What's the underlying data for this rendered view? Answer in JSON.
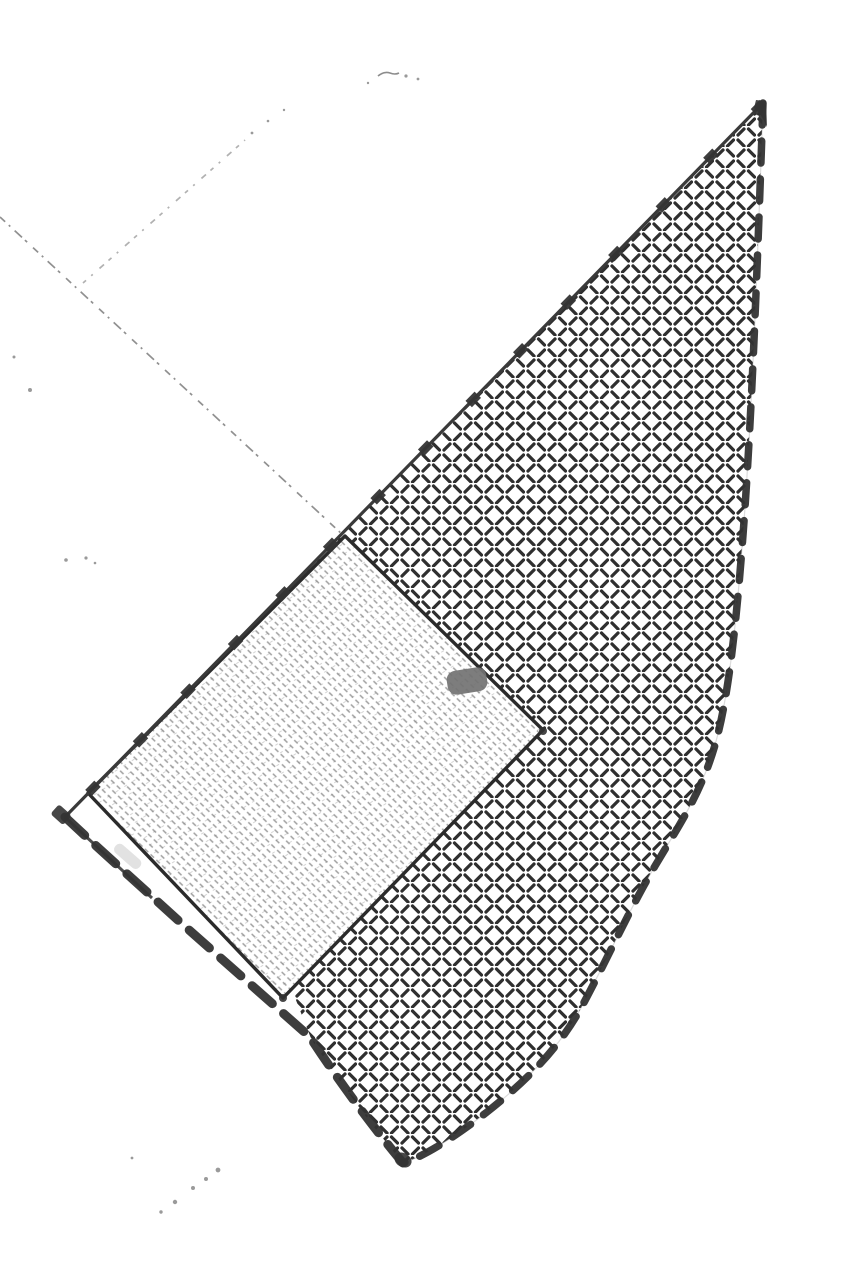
{
  "scene": {
    "type": "scanned hand-drawn cadastral sketch",
    "background": "#ffffff",
    "regions": {
      "hatched_parcel": "large curved triangular area filled with alternating diagonal dash hatching, bounded by heavy dashed ink lines",
      "ruled_parcel": "rotated rectangular area filled with fine broken ruled shading, thin solid ink border",
      "gap_strip": "narrow white strip between rectangle bottom edge and heavy dashed boundary",
      "redaction_blob": "small solid gray rounded blob near rectangle top edge",
      "pencil_lines": "faint broken pencil construction lines extending to upper left"
    }
  },
  "colors": {
    "ink": "#2f2f2f",
    "ink_soft": "#333333",
    "pencil": "#7d7d7d",
    "texture": "#606060",
    "smudge": "#cacaca",
    "blob_gray": "#727272",
    "background": "#ffffff"
  },
  "geometry": {
    "sail_fill": "M763 103 C757 280 751 430 743 535 C736 628 728 700 715 745 C701 793 681 822 655 866 C628 912 607 960 581 1008 C556 1053 521 1085 487 1112 C460 1133 426 1156 403 1163 C381 1137 341 1085 310 1037 L180 922 C145 890 100 850 65 817 Z",
    "sail_right_edge": "M763 103 C757 280 751 430 743 535 C736 628 728 700 715 745 C701 793 681 822 655 866 C628 912 607 960 581 1008 C556 1053 521 1085 487 1112 C460 1133 426 1156 403 1163",
    "sail_left_edge": "M763 103 L65 817",
    "sail_bottom_edge": "M65 817 C100 850 145 890 180 922 L310 1037 C341 1085 381 1137 403 1163",
    "sail_bottom_solid": "M65 817 L152 898",
    "gap_strip": "94,788 292,990 314,1046 58,822",
    "parcel": "345,536 543,730 283,998 88,793",
    "pencil_line_a": "M0 217 L343 535",
    "pencil_line_b": "M83 283 L245 140",
    "squiggle": "M378 76 Q384 71 390 73 Q395 75 399 73",
    "specks_upper": "M14 357 m-1.5 0 a1.5 1.5 0 1 0 3 0 a1.5 1.5 0 1 0 -3 0 Z M30 390 m-2 0 a2 2 0 1 0 4 0 a2 2 0 1 0 -4 0 Z M66 560 m-1.8 0 a1.8 1.8 0 1 0 3.6 0 a1.8 1.8 0 1 0 -3.6 0 Z M86 558 m-1.6 0 a1.6 1.6 0 1 0 3.2 0 a1.6 1.6 0 1 0 -3.2 0 Z M95 563 m-1.3 0 a1.3 1.3 0 1 0 2.6 0 a1.3 1.3 0 1 0 -2.6 0 Z M406 76 m-1.6 0 a1.6 1.6 0 1 0 3.2 0 a1.6 1.6 0 1 0 -3.2 0 Z M418 79 m-1.4 0 a1.4 1.4 0 1 0 2.8 0 a1.4 1.4 0 1 0 -2.8 0 Z M368 83 m-1.2 0 a1.2 1.2 0 1 0 2.4 0 a1.2 1.2 0 1 0 -2.4 0 Z M252 133 m-1.4 0 a1.4 1.4 0 1 0 2.8 0 a1.4 1.4 0 1 0 -2.8 0 Z M268 121 m-1.3 0 a1.3 1.3 0 1 0 2.6 0 a1.3 1.3 0 1 0 -2.6 0 Z M284 110 m-1.2 0 a1.2 1.2 0 1 0 2.4 0 a1.2 1.2 0 1 0 -2.4 0 Z",
    "specks_trail": "M218 1170 m-2.4 0 a2.4 2.4 0 1 0 4.8 0 a2.4 2.4 0 1 0 -4.8 0 Z M206 1179 m-2 0 a2 2 0 1 0 4 0 a2 2 0 1 0 -4 0 Z M193 1188 m-2 0 a2 2 0 1 0 4 0 a2 2 0 1 0 -4 0 Z M175 1202 m-2.2 0 a2.2 2.2 0 1 0 4.4 0 a2.2 2.2 0 1 0 -4.4 0 Z M161 1212 m-1.7 0 a1.7 1.7 0 1 0 3.4 0 a1.7 1.7 0 1 0 -3.4 0 Z M132 1158 m-1.4 0 a1.4 1.4 0 1 0 2.8 0 a1.4 1.4 0 1 0 -2.8 0 Z",
    "apex_blotch": "M756 100 L766 101 L767 127 Q761 113 754 108 Z"
  }
}
